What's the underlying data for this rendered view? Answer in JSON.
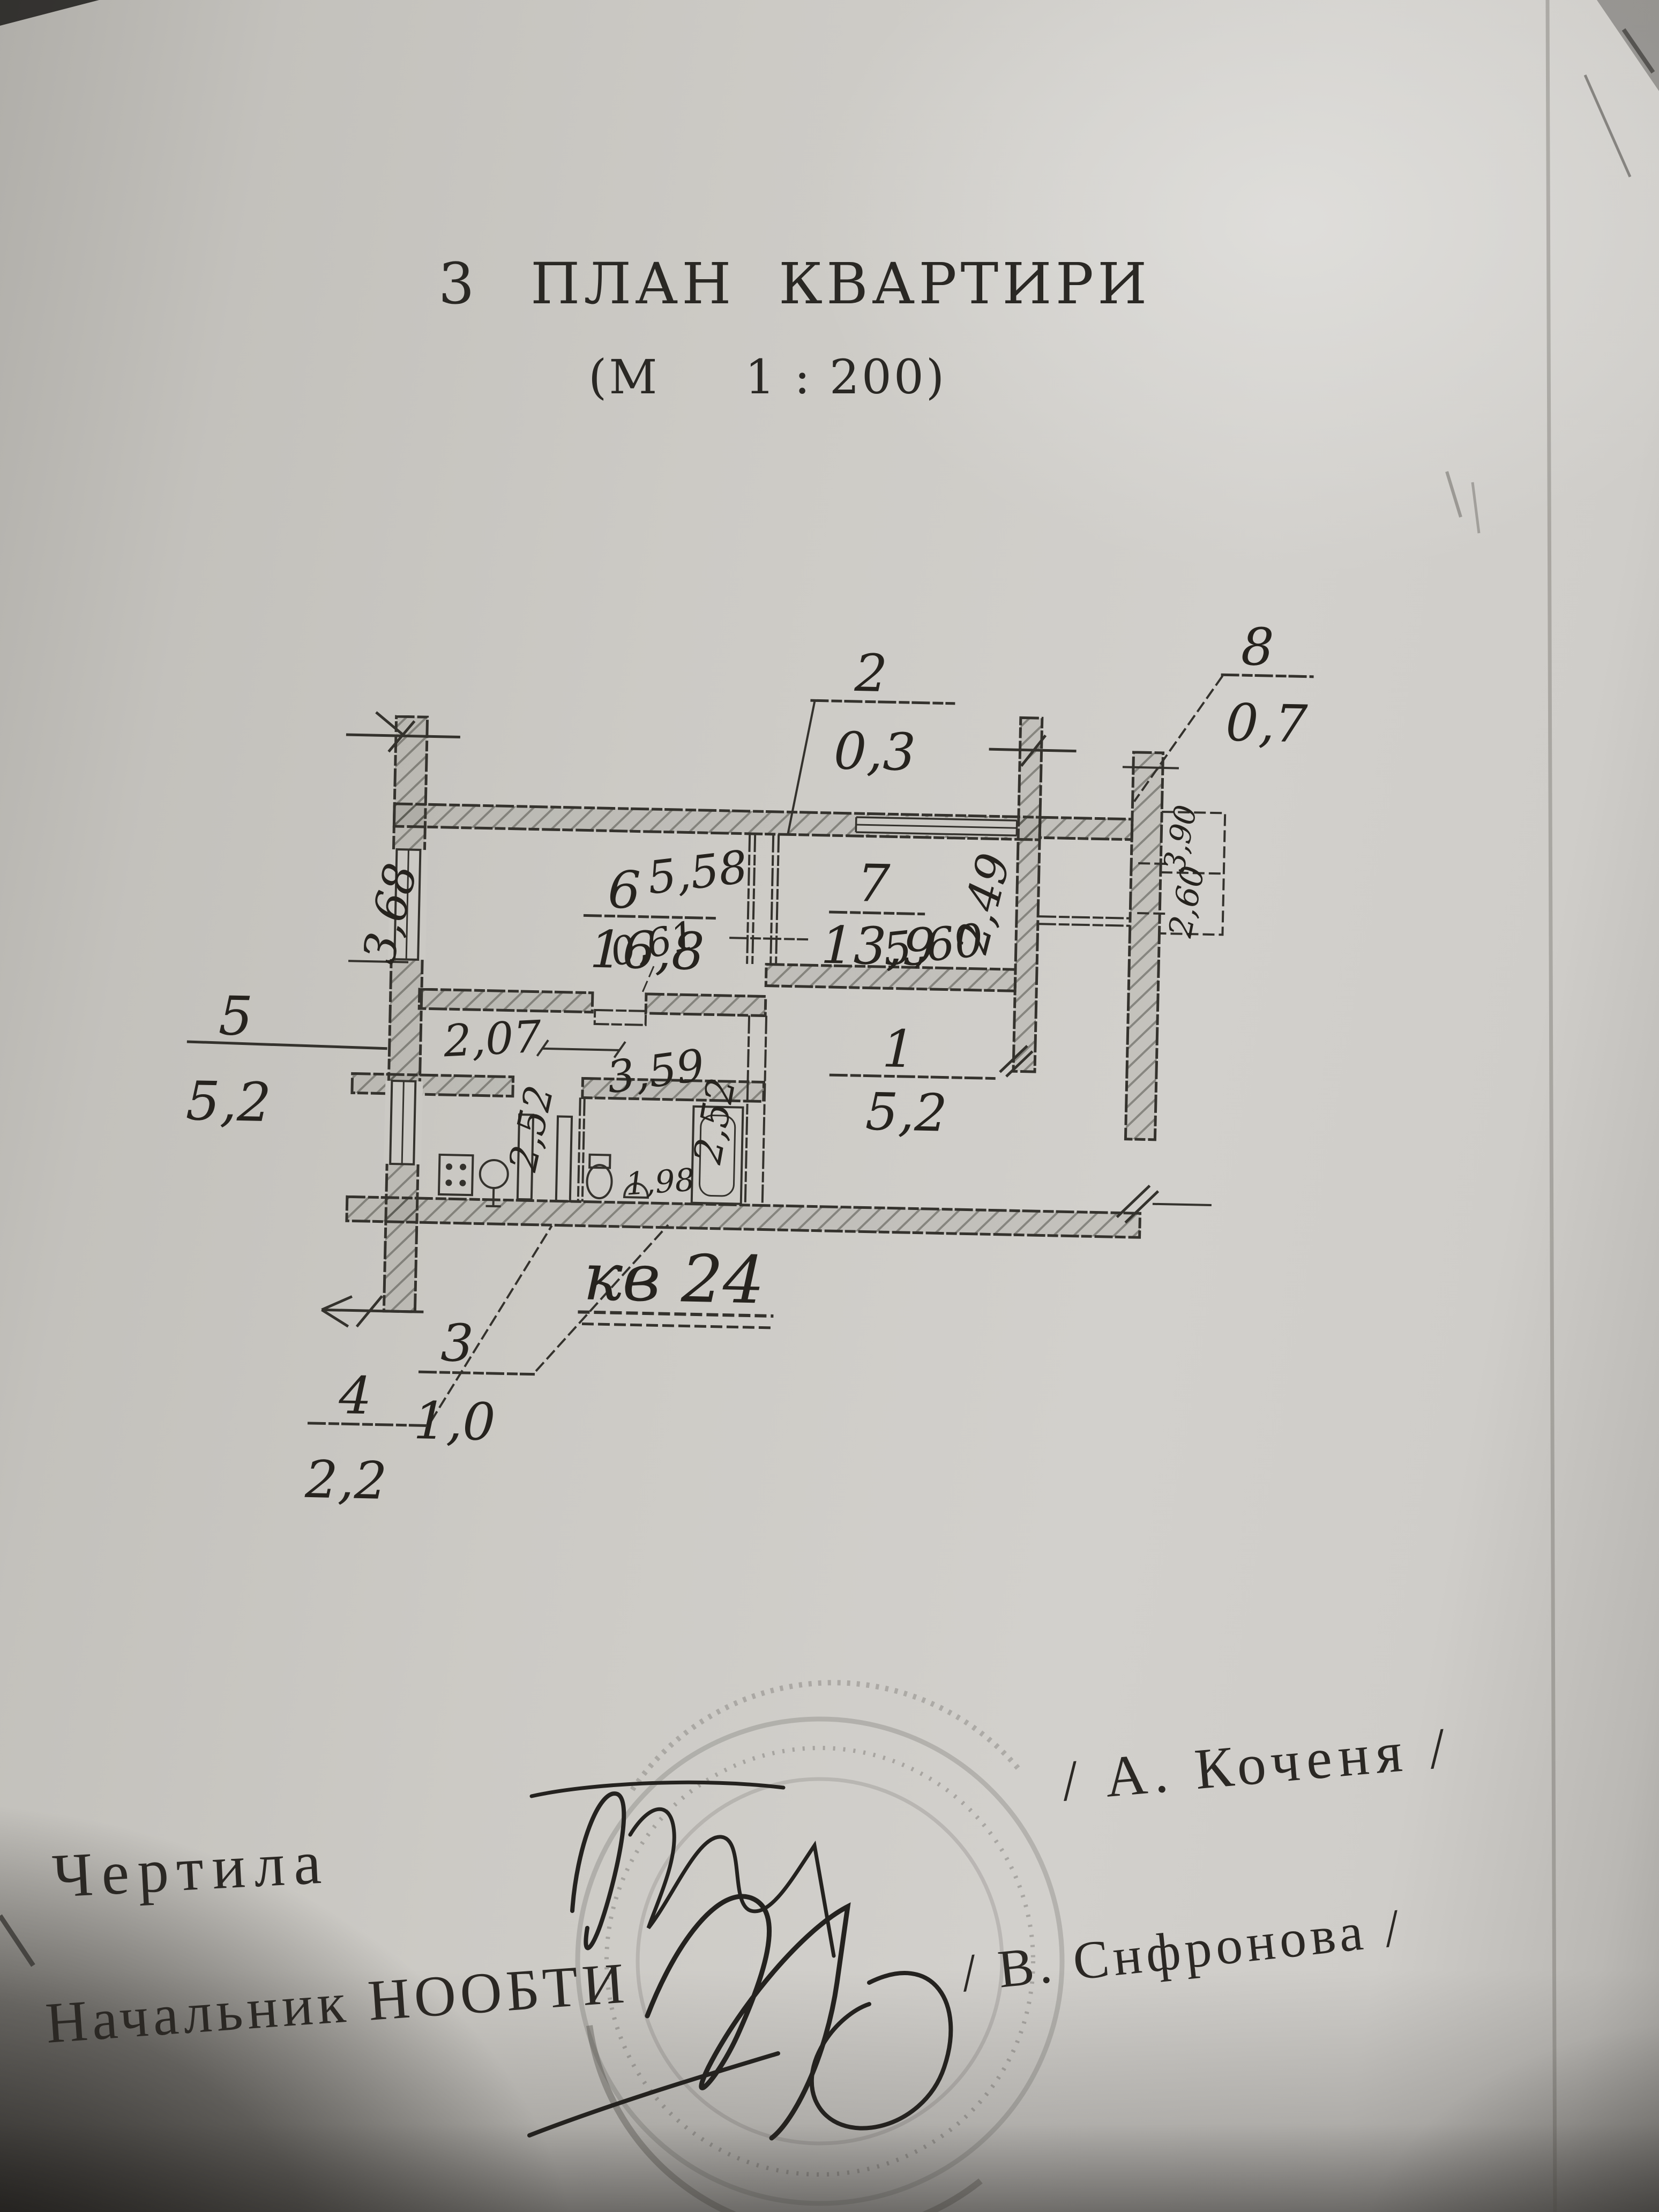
{
  "title": {
    "number": "3",
    "text": "ПЛАН  КВАРТИРИ",
    "scale": "(М     1 : 200)"
  },
  "plan": {
    "apartment_label": "кв 24",
    "rooms": [
      {
        "id": "6",
        "area": "16,8"
      },
      {
        "id": "7",
        "area": "13,9"
      },
      {
        "id": "1",
        "area": "5,2"
      }
    ],
    "callouts": [
      {
        "id": "2",
        "area": "0,3"
      },
      {
        "id": "8",
        "area": "0,7"
      },
      {
        "id": "5",
        "area": "5,2"
      },
      {
        "id": "3",
        "area": "1,0"
      },
      {
        "id": "4",
        "area": "2,2"
      }
    ],
    "dims": {
      "room6_top": "5,58",
      "room6_left": "3,68",
      "closet": "0,61",
      "corridor_a": "2,07",
      "corridor_b": "3,59",
      "kitchen_v": "2,52",
      "bath_v": "2,52",
      "bath_w": "1,98",
      "room7_bottom": "5,60",
      "room7_right": "2,49",
      "balcony_a": "3,90",
      "balcony_b": "2,60"
    }
  },
  "footer": {
    "drafted_label": "Чертила",
    "drafted_name": "/ А. Коченя /",
    "chief_label": "Начальник НООБТИ",
    "chief_name": "/ В. Снфронова /"
  }
}
